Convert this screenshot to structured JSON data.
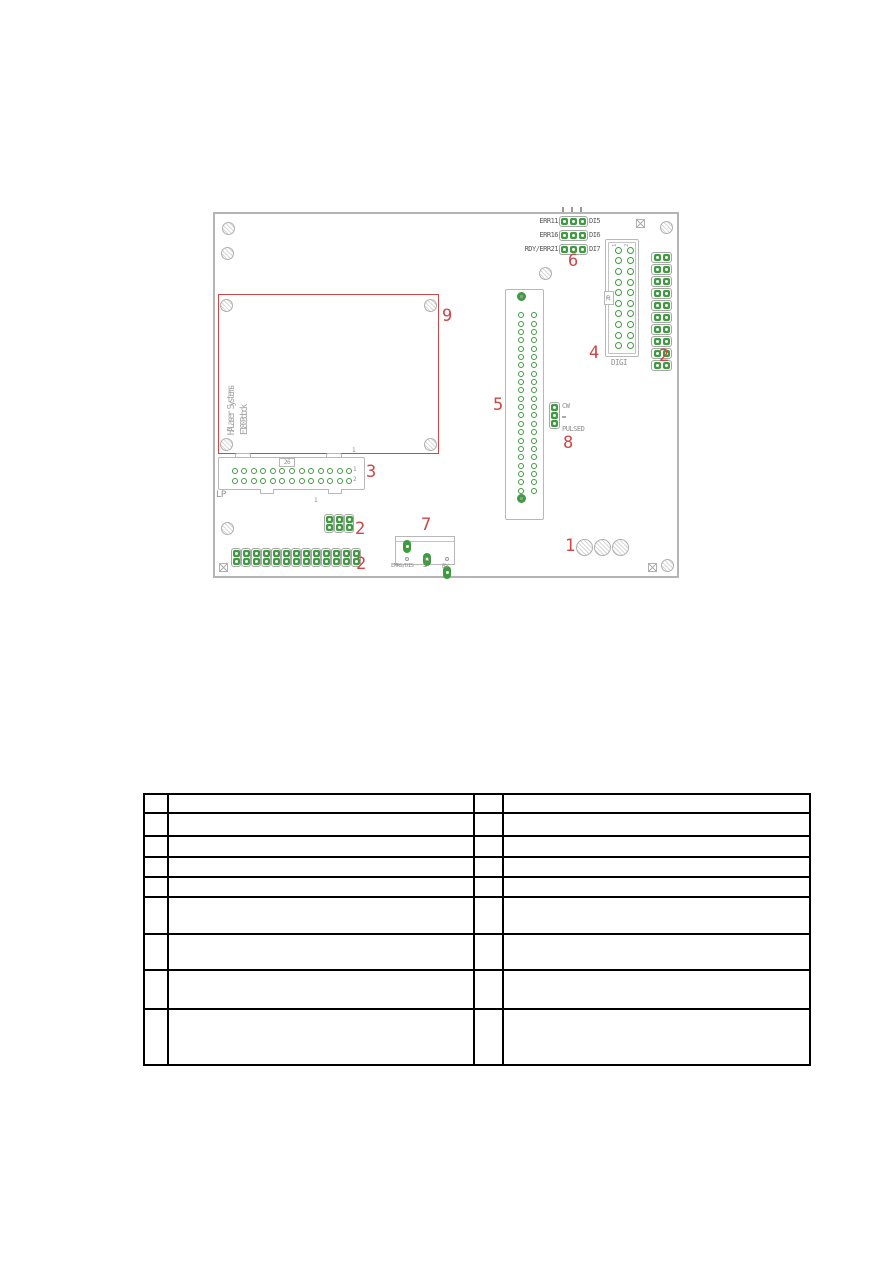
{
  "board": {
    "silkscreen": {
      "brand_line1": "HALaser Systems",
      "brand_line2": "E1803dock",
      "jumper_rows": [
        {
          "left": "ERR11",
          "right": "DI5"
        },
        {
          "left": "ERR16",
          "right": "DI6"
        },
        {
          "left": "RDY/ERR21",
          "right": "DI7"
        }
      ],
      "digi_label": "DIGI",
      "digi_pin20": "20",
      "digi_col1": "1",
      "digi_col2": "2",
      "lp_label": "LP",
      "lp_pin26": "26",
      "lp_row1": "1",
      "lp_row2": "2",
      "lp_pin1_top": "1",
      "lp_pin1_bottom": "1",
      "mode_top": "CW",
      "mode_bottom": "PULSED",
      "terminal_labels": {
        "left": "EMRG/DIS",
        "middle": "⊥",
        "right": "BV"
      }
    },
    "callouts": {
      "c1": "1",
      "c2": "2",
      "c3": "3",
      "c4": "4",
      "c5": "5",
      "c6": "6",
      "c7": "7",
      "c8": "8",
      "c9": "9"
    },
    "colors": {
      "pad_green": "#3f9b3f",
      "callout_red": "#d04545",
      "outline_gray": "#b4b4b4",
      "silkscreen_gray": "#8e8e8e"
    }
  },
  "table": {
    "columns": 4,
    "rows": [
      [
        "",
        "",
        "",
        ""
      ],
      [
        "",
        "",
        "",
        ""
      ],
      [
        "",
        "",
        "",
        ""
      ],
      [
        "",
        "",
        "",
        ""
      ],
      [
        "",
        "",
        "",
        ""
      ],
      [
        "",
        "",
        "",
        ""
      ],
      [
        "",
        "",
        "",
        ""
      ],
      [
        "",
        "",
        "",
        ""
      ],
      [
        "",
        "",
        "",
        ""
      ]
    ]
  }
}
